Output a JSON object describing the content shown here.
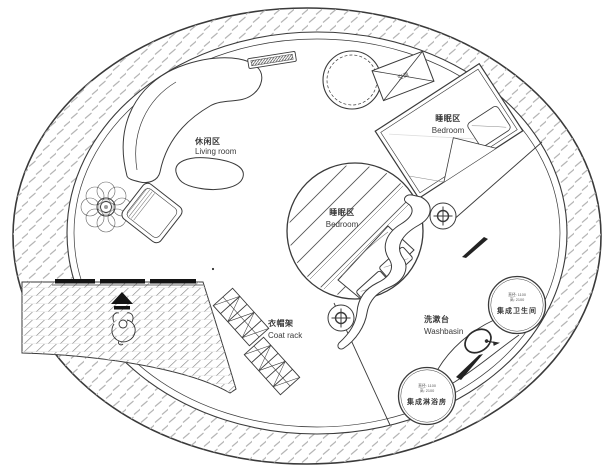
{
  "colors": {
    "line": "#3a3a3a",
    "hatch": "#b5b5b5",
    "deck_hatch": "#9a9a9a",
    "solid_black": "#141414",
    "background": "#ffffff"
  },
  "areas": {
    "living": {
      "zh": "休闲区",
      "en": "Living room"
    },
    "bedroom_loft": {
      "zh": "睡眠区",
      "en": "Bedroom"
    },
    "bedroom_main": {
      "zh": "睡眠区",
      "en": "Bedroom"
    },
    "coat_rack": {
      "zh": "衣帽架",
      "en": "Coat rack"
    },
    "washbasin": {
      "zh": "洗漱台",
      "en": "Washbasin"
    },
    "bathroom": {
      "zh": "集成卫生间",
      "dim1": "直径: 1100",
      "dim2": "高: 2100"
    },
    "shower": {
      "zh": "集成淋浴房",
      "dim1": "直径: 1100",
      "dim2": "高: 2100"
    },
    "ac": {
      "zh": "空调"
    }
  }
}
